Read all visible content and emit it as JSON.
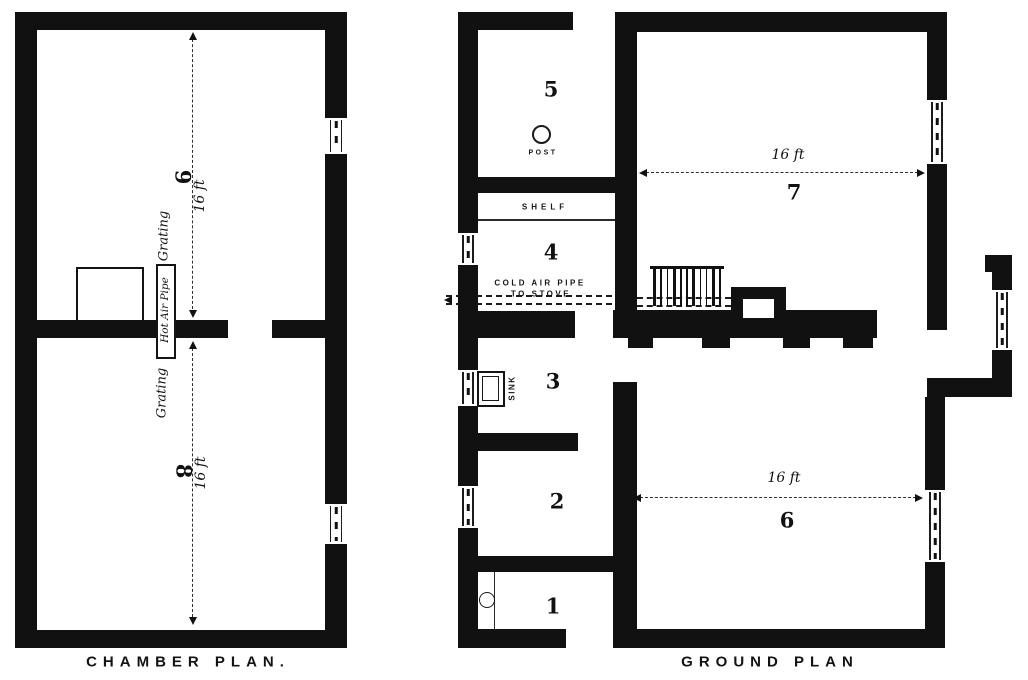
{
  "colors": {
    "ink": "#111111",
    "paper": "#ffffff"
  },
  "chamber_plan": {
    "title": "CHAMBER PLAN.",
    "upper_room": {
      "number": "9",
      "dimension": "16 ft"
    },
    "lower_room": {
      "number": "8",
      "dimension": "16 ft"
    },
    "grating_upper": "Grating",
    "grating_lower": "Grating",
    "hot_air_pipe": "Hot Air Pipe"
  },
  "ground_plan": {
    "title": "GROUND PLAN",
    "rooms": {
      "r1": "1",
      "r2": "2",
      "r3": "3",
      "r4": "4",
      "r5": "5",
      "r6": "6",
      "r7": "7"
    },
    "room_7_dimension": "16 ft",
    "room_6_dimension": "16 ft",
    "post_label": "POST",
    "shelf_label": "SHELF",
    "sink_label": "SINK",
    "cold_air_line1": "COLD AIR PIPE",
    "cold_air_line2": "TO STOVE"
  }
}
